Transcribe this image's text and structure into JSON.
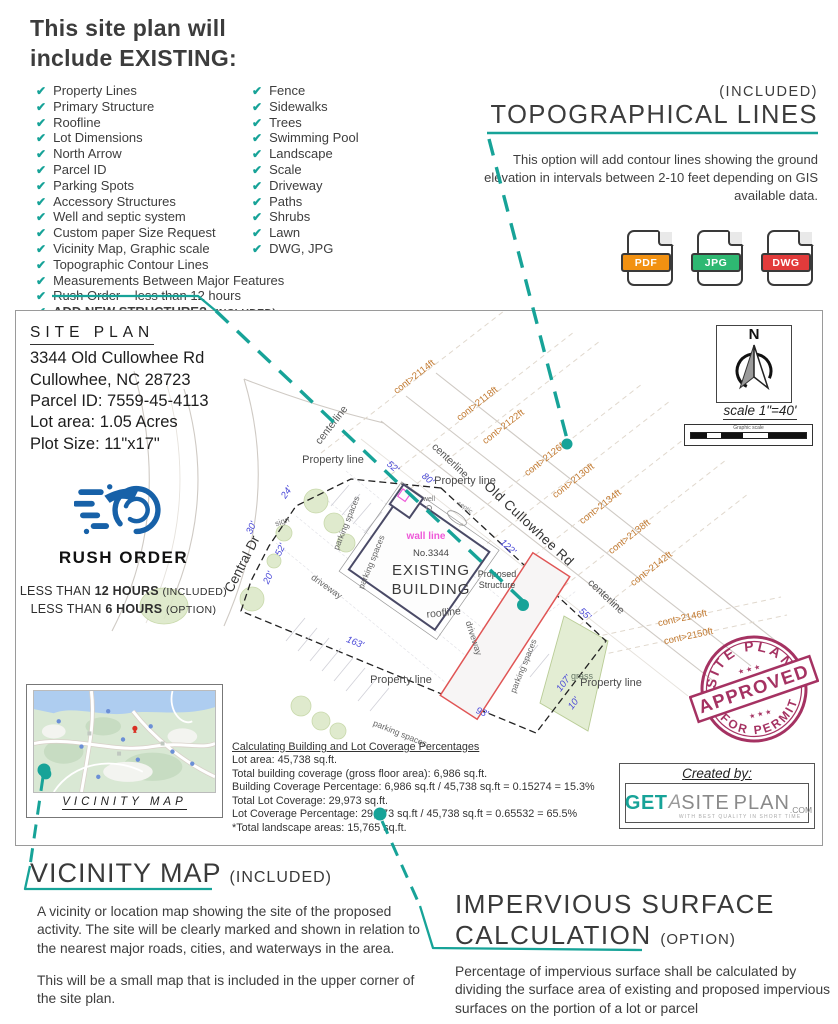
{
  "colors": {
    "teal": "#17A398",
    "contour_orange": "#C2792F",
    "dimension_blue": "#4A49D8",
    "stamp_maroon": "#9E2155",
    "rush_blue": "#1761A8",
    "pdf_orange": "#F29111",
    "jpg_green": "#2EB872",
    "dwg_red": "#E23B3B",
    "wall_line_magenta": "#EE58D8"
  },
  "header": {
    "title1": "This site plan will",
    "title2": "include EXISTING:"
  },
  "checklist": {
    "left": [
      "Property Lines",
      "Primary Structure",
      "Roofline",
      "Lot Dimensions",
      "North Arrow",
      "Parcel ID",
      "Parking Spots",
      "Accessory Structures",
      "Well and septic system",
      "Custom paper Size Request",
      "Vicinity Map, Graphic scale",
      "Topographic Contour Lines",
      "Measurements Between Major Features",
      "Rush Order – less than 12 hours"
    ],
    "add_new": {
      "label": "ADD NEW STRUCTURE?",
      "suffix": "(INCLUDED)"
    },
    "right": [
      "Fence",
      "Sidewalks",
      "Trees",
      "Swimming Pool",
      "Landscape",
      "Scale",
      "Driveway",
      "Paths",
      "Shrubs",
      "Lawn",
      "DWG, JPG"
    ]
  },
  "topo": {
    "included": "(INCLUDED)",
    "title": "TOPOGRAPHICAL LINES",
    "description": "This option will add contour lines showing the ground elevation in intervals between 2-10 feet depending on GIS available data.",
    "badges": [
      "PDF",
      "JPG",
      "DWG"
    ]
  },
  "plan": {
    "info": {
      "title": "SITE PLAN",
      "address1": "3344 Old Cullowhee Rd",
      "address2": "Cullowhee, NC 28723",
      "parcel": "Parcel ID: 7559-45-4113",
      "lot": "Lot area: 1.05 Acres",
      "plot": "Plot Size: 11\"x17\""
    },
    "rush": {
      "title": "RUSH ORDER",
      "line1": {
        "pre": "LESS THAN",
        "bold": "12 HOURS",
        "note": "(INCLUDED)"
      },
      "line2": {
        "pre": "LESS THAN",
        "bold": "6 HOURS",
        "note": "(OPTION)"
      }
    },
    "north": {
      "letter": "N",
      "scale": "scale 1\"=40'",
      "graphic": "Graphic scale"
    },
    "roads": {
      "main": "Old Cullowhee Rd",
      "side": "Central Dr"
    },
    "labels": {
      "centerline": "centerline",
      "property_line": "Property line",
      "driveway": "driveway",
      "parking": "parking spaces",
      "sign": "sign",
      "well": "well",
      "septic": "septic",
      "wall_line": "wall line",
      "roofline": "roofline",
      "grass": "grass"
    },
    "building": {
      "no": "No.3344",
      "name1": "EXISTING",
      "name2": "BUILDING"
    },
    "proposed": {
      "l1": "Proposed",
      "l2": "Structure"
    },
    "dims": [
      "52'",
      "80'",
      "24'",
      "30'",
      "52'",
      "20'",
      "163'",
      "93'",
      "122'",
      "55'",
      "107'",
      "10'"
    ],
    "contours": [
      "cont>2114ft",
      "cont>2118ft",
      "cont>2122ft",
      "cont>2126ft",
      "cont>2130ft",
      "cont>2134ft",
      "cont>2138ft",
      "cont>2142ft",
      "cont>2146ft",
      "cont>2150ft"
    ],
    "vicinity_label": "VICINITY MAP",
    "calc": {
      "title": "Calculating Building and Lot Coverage Percentages",
      "lines": [
        "Lot area: 45,738 sq.ft.",
        "Total building coverage (gross floor area): 6,986 sq.ft.",
        "Building Coverage Percentage: 6,986 sq.ft / 45,738 sq.ft = 0.15274 = 15.3%",
        "Total Lot Coverage: 29,973 sq.ft.",
        "Lot Coverage Percentage: 29,973 sq.ft / 45,738 sq.ft = 0.65532 = 65.5%",
        "*Total landscape areas: 15,765 sq.ft."
      ]
    },
    "stamp": {
      "arc_top": "SITE PLAN",
      "banner": "APPROVED",
      "arc_bottom": "FOR PERMIT",
      "stars": "★ ★ ★"
    },
    "created": {
      "label": "Created by:",
      "get": "GET",
      "a": "A",
      "site": "SITE",
      "plan": "PLAN",
      "com": ".COM",
      "tagline": "WITH BEST QUALITY IN SHORT TIME"
    }
  },
  "vicinity": {
    "title": "VICINITY MAP",
    "badge": "(INCLUDED)",
    "p1": "A vicinity or location map showing the site of the proposed activity. The site will be clearly marked and shown in relation to the nearest major roads, cities, and waterways in the area.",
    "p2": "This will be a small map that is included in the upper corner of the site plan."
  },
  "impervious": {
    "title1": "IMPERVIOUS SURFACE",
    "title2": "CALCULATION",
    "badge": "(OPTION)",
    "p": "Percentage of impervious surface shall be calculated by dividing the surface area of existing and proposed impervious surfaces on the portion of a lot or parcel"
  }
}
